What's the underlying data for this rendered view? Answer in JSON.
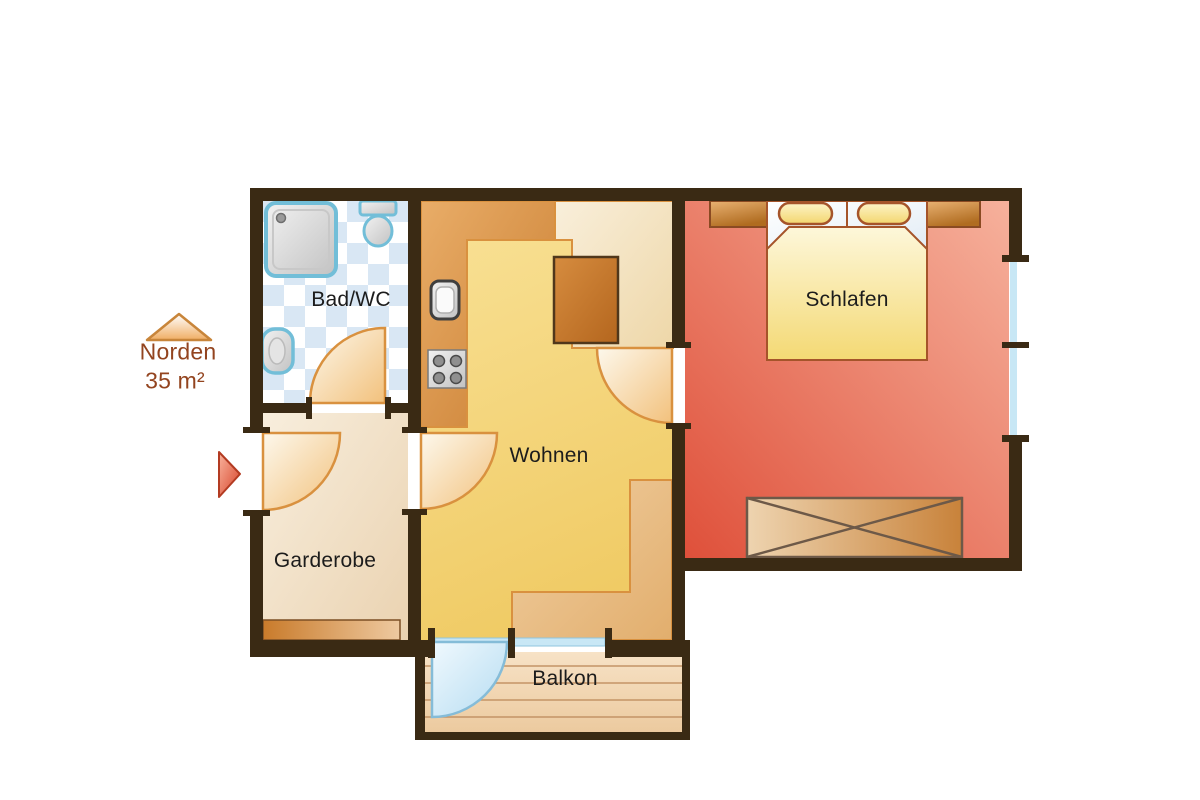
{
  "labels": {
    "bad": "Bad/WC",
    "wohnen": "Wohnen",
    "schlafen": "Schlafen",
    "garderobe": "Garderobe",
    "balkon": "Balkon"
  },
  "compass": {
    "direction": "Norden",
    "area": "35 m²"
  },
  "colors": {
    "wall": "#3a2a14",
    "bath_tile": "#d9e7f4",
    "fixture_border": "#72bed8",
    "wohnen_floor": "#f5d77e",
    "kitchen_counter": "#d9943f",
    "dining_cream": "#f3e1bd",
    "table": "#c47a2e",
    "schlafen_floor": "#e97258",
    "bed_blanket": "#f6e0a0",
    "furniture_wood": "#d0893c",
    "garderobe_floor": "#f2e2c9",
    "balcony_floor": "#f2d6b2",
    "door_arc": "#d9913f",
    "glass": "#c8e7f5",
    "label_text": "#1c1c1c",
    "compass_text": "#93441f",
    "entrance_arrow": "#d64228"
  }
}
